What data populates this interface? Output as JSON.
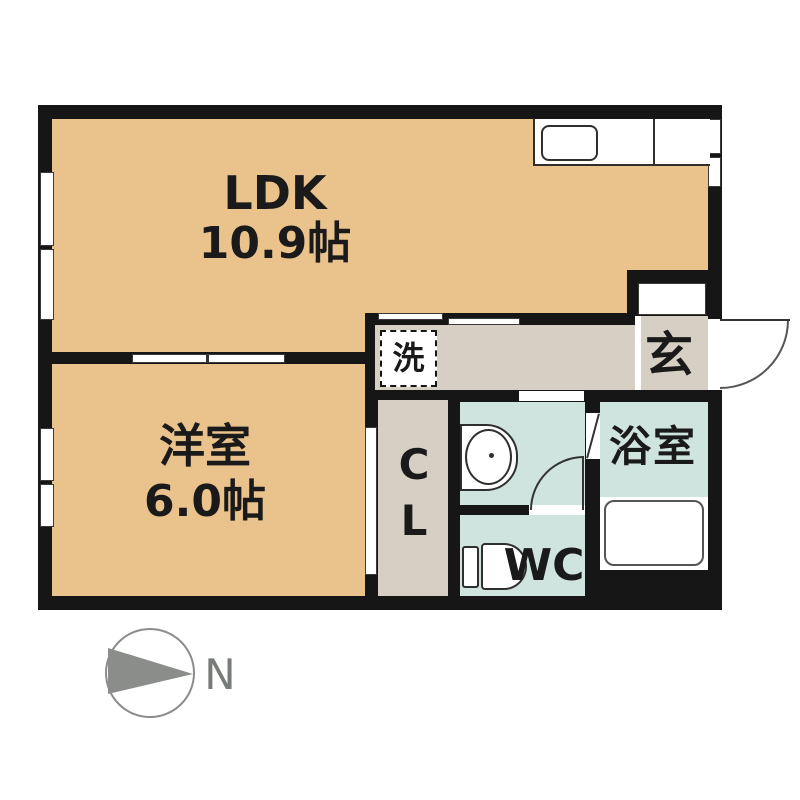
{
  "plan": {
    "rooms": {
      "ldk": {
        "label": "LDK",
        "size": "10.9帖"
      },
      "western": {
        "label": "洋室",
        "size": "6.0帖"
      },
      "entrance": {
        "label": "玄"
      },
      "laundry": {
        "label": "洗"
      },
      "closet": {
        "line1": "C",
        "line2": "L"
      },
      "wc": {
        "label": "WC"
      },
      "bath": {
        "label": "浴室"
      }
    }
  },
  "compass": {
    "label": "N"
  },
  "colors": {
    "room_tan": "#e9c28c",
    "hall_gray": "#d5d0c3",
    "wet_area_cyan": "#cfe3df",
    "wall_black": "#161616",
    "compass_gray": "#8a8d8a"
  }
}
